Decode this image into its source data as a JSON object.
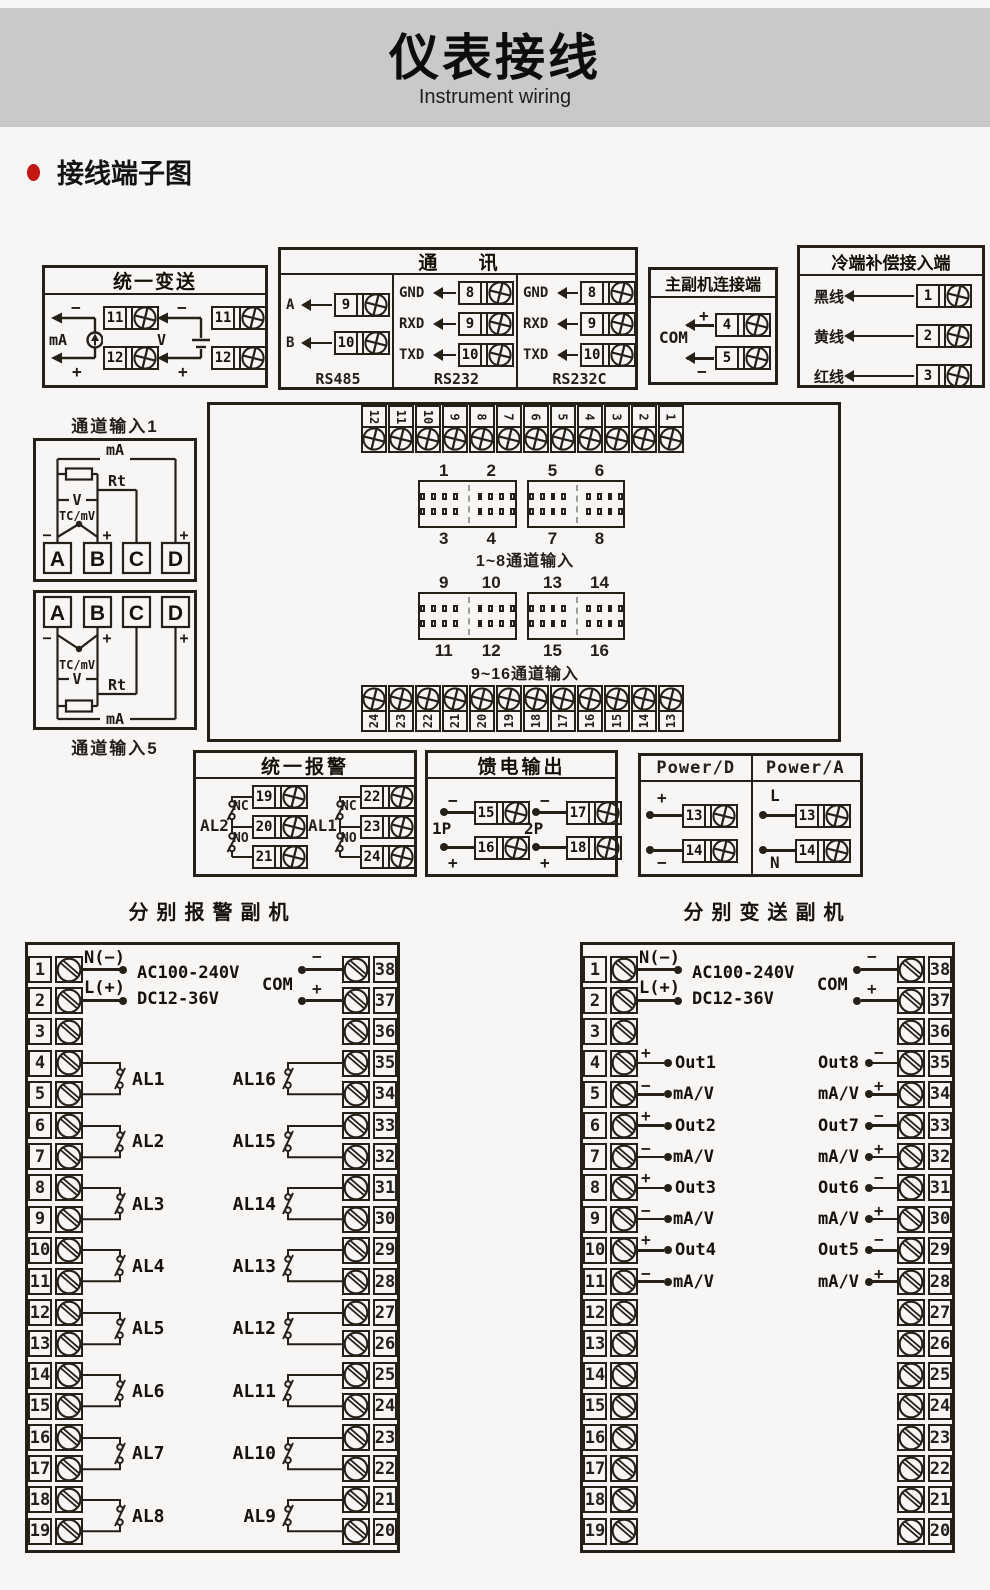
{
  "page": {
    "title": "仪表接线",
    "subtitle": "Instrument wiring",
    "section_title": "接线端子图"
  },
  "colors": {
    "accent_red": "#c41715",
    "ink": "#262019",
    "band_gray": "#c9c9c9",
    "background": "#f7f6f4"
  },
  "unified_transmit": {
    "title": "统一变送",
    "ma": {
      "label": "mA",
      "minus": "−",
      "plus": "+",
      "terminals": [
        "11",
        "12"
      ]
    },
    "v": {
      "label": "V",
      "minus": "−",
      "plus": "+",
      "terminals": [
        "11",
        "12"
      ]
    }
  },
  "comm": {
    "title": "通 讯",
    "columns": [
      {
        "name": "RS485",
        "rows": [
          [
            "A",
            "9"
          ],
          [
            "B",
            "10"
          ]
        ]
      },
      {
        "name": "RS232",
        "rows": [
          [
            "GND",
            "8"
          ],
          [
            "RXD",
            "9"
          ],
          [
            "TXD",
            "10"
          ]
        ]
      },
      {
        "name": "RS232C",
        "rows": [
          [
            "GND",
            "8"
          ],
          [
            "RXD",
            "9"
          ],
          [
            "TXD",
            "10"
          ]
        ]
      }
    ]
  },
  "master_slave": {
    "title": "主副机连接端",
    "com": "COM",
    "rows": [
      [
        "+",
        "4"
      ],
      [
        "−",
        "5"
      ]
    ]
  },
  "cold_comp": {
    "title": "冷端补偿接入端",
    "rows": [
      [
        "黑线",
        "1"
      ],
      [
        "黄线",
        "2"
      ],
      [
        "红线",
        "3"
      ]
    ]
  },
  "ch1": {
    "title": "通道输入1",
    "ma": "mA",
    "rt": "Rt",
    "v": "V",
    "tc": "TC/mV",
    "minus": "−",
    "plus": "+",
    "terminals": [
      "A",
      "B",
      "C",
      "D"
    ]
  },
  "ch5": {
    "title": "通道输入5",
    "ma": "mA",
    "rt": "Rt",
    "v": "V",
    "tc": "TC/mV",
    "minus": "−",
    "plus": "+",
    "terminals": [
      "A",
      "B",
      "C",
      "D"
    ]
  },
  "main_board": {
    "top_terminals": [
      "12",
      "11",
      "10",
      "9",
      "8",
      "7",
      "6",
      "5",
      "4",
      "3",
      "2",
      "1"
    ],
    "bottom_terminals": [
      "24",
      "23",
      "22",
      "21",
      "20",
      "19",
      "18",
      "17",
      "16",
      "15",
      "14",
      "13"
    ],
    "header_row1": {
      "labels_top": [
        "1",
        "2",
        "5",
        "6"
      ],
      "labels_bottom": [
        "3",
        "4",
        "7",
        "8"
      ],
      "caption": "1~8通道输入"
    },
    "header_row2": {
      "labels_top": [
        "9",
        "10",
        "13",
        "14"
      ],
      "labels_bottom": [
        "11",
        "12",
        "15",
        "16"
      ],
      "caption": "9~16通道输入"
    }
  },
  "unified_alarm": {
    "title": "统一报警",
    "groups": [
      {
        "name": "AL2",
        "nc": "NC",
        "no": "NO",
        "terminals": [
          "19",
          "20",
          "21"
        ]
      },
      {
        "name": "AL1",
        "nc": "NC",
        "no": "NO",
        "terminals": [
          "22",
          "23",
          "24"
        ]
      }
    ]
  },
  "feed_output": {
    "title": "馈电输出",
    "groups": [
      {
        "name": "1P",
        "minus": "−",
        "plus": "+",
        "terminals": [
          "15",
          "16"
        ]
      },
      {
        "name": "2P",
        "minus": "−",
        "plus": "+",
        "terminals": [
          "17",
          "18"
        ]
      }
    ]
  },
  "power": {
    "columns": [
      {
        "title": "Power/D",
        "rows": [
          [
            "+",
            "13"
          ],
          [
            "−",
            "14"
          ]
        ]
      },
      {
        "title": "Power/A",
        "rows": [
          [
            "L",
            "13"
          ],
          [
            "N",
            "14"
          ]
        ]
      }
    ]
  },
  "alarm_unit": {
    "title": "分别报警副机",
    "supply": {
      "n": "N(−)",
      "l": "L(+)",
      "line1": "AC100-240V",
      "line2": "DC12-36V"
    },
    "com": {
      "label": "COM",
      "minus": "−",
      "plus": "+"
    },
    "left_terminals": [
      "1",
      "2",
      "3",
      "4",
      "5",
      "6",
      "7",
      "8",
      "9",
      "10",
      "11",
      "12",
      "13",
      "14",
      "15",
      "16",
      "17",
      "18",
      "19"
    ],
    "right_terminals": [
      "38",
      "37",
      "36",
      "35",
      "34",
      "33",
      "32",
      "31",
      "30",
      "29",
      "28",
      "27",
      "26",
      "25",
      "24",
      "23",
      "22",
      "21",
      "20"
    ],
    "left_groups": [
      "AL1",
      "AL2",
      "AL3",
      "AL4",
      "AL5",
      "AL6",
      "AL7",
      "AL8"
    ],
    "right_groups": [
      "AL16",
      "AL15",
      "AL14",
      "AL13",
      "AL12",
      "AL11",
      "AL10",
      "AL9"
    ]
  },
  "transmit_unit": {
    "title": "分别变送副机",
    "supply": {
      "n": "N(−)",
      "l": "L(+)",
      "line1": "AC100-240V",
      "line2": "DC12-36V"
    },
    "com": {
      "label": "COM",
      "minus": "−",
      "plus": "+"
    },
    "left_terminals": [
      "1",
      "2",
      "3",
      "4",
      "5",
      "6",
      "7",
      "8",
      "9",
      "10",
      "11",
      "12",
      "13",
      "14",
      "15",
      "16",
      "17",
      "18",
      "19"
    ],
    "right_terminals": [
      "38",
      "37",
      "36",
      "35",
      "34",
      "33",
      "32",
      "31",
      "30",
      "29",
      "28",
      "27",
      "26",
      "25",
      "24",
      "23",
      "22",
      "21",
      "20"
    ],
    "left_outputs": [
      "Out1",
      "Out2",
      "Out3",
      "Out4"
    ],
    "right_outputs": [
      "Out8",
      "Out7",
      "Out6",
      "Out5"
    ],
    "signal": "mA/V",
    "plus": "+",
    "minus": "−"
  }
}
